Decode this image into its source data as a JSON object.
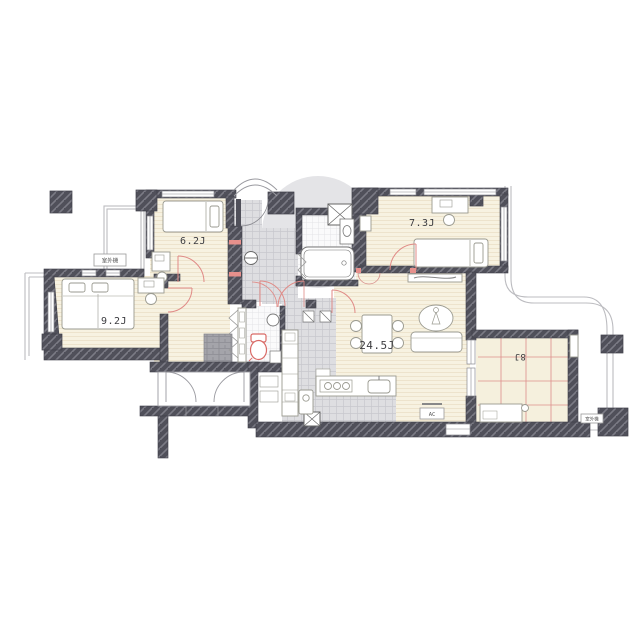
{
  "plan": {
    "title": "apartment-floor-plan",
    "rooms": [
      {
        "name": "bedroom-6-2",
        "label": "6.2J"
      },
      {
        "name": "bedroom-7-3",
        "label": "7.3J"
      },
      {
        "name": "bedroom-9-2",
        "label": "9.2J"
      },
      {
        "name": "living-dining-kitchen",
        "label": "24.5J"
      },
      {
        "name": "japanese-room",
        "label": "8J"
      }
    ],
    "labels": {
      "outdoor_unit_left": "室外機",
      "outdoor_unit_right": "室外機",
      "air_conditioner": "AC"
    },
    "colors": {
      "wall": "#50505a",
      "wall_hatch": "#7b7b85",
      "wood_floor": "#f7f2e1",
      "tile": "#dedee1",
      "dark_tile": "#a4a4aa",
      "tatami_grid": "#dd8e8c",
      "door_red": "#e08a86",
      "rail": "#bcbcc0"
    }
  }
}
